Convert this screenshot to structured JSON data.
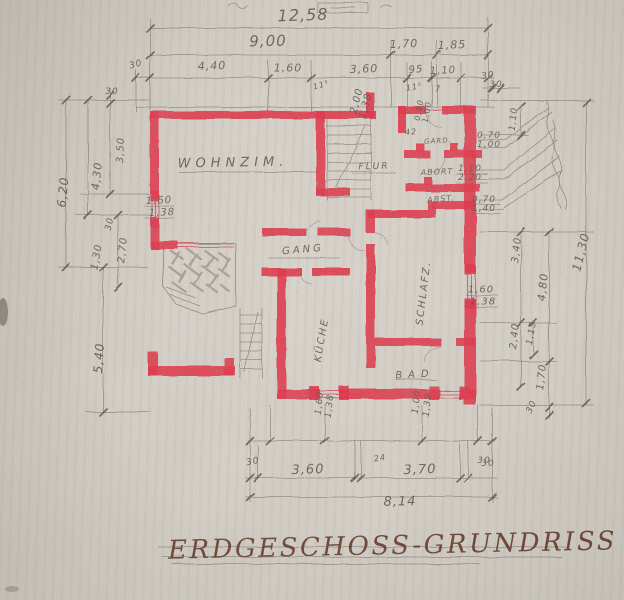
{
  "drawing": {
    "title": "ERDGESCHOSS-GRUNDRISS"
  },
  "colors": {
    "paper": "#d6d2ca",
    "wall_red": "#e23348",
    "pencil": "#6d665a",
    "title_ink": "#5a2c1b"
  },
  "room_labels": [
    {
      "name": "room-label-wohnzimmer",
      "text": "WOHNZIM.",
      "x": 233,
      "y": 163,
      "size": 13,
      "rot": -1,
      "ls": 5
    },
    {
      "name": "room-label-flur",
      "text": "FLUR",
      "x": 374,
      "y": 167,
      "size": 9,
      "rot": -2,
      "ls": 2
    },
    {
      "name": "room-label-gang",
      "text": "GANG",
      "x": 303,
      "y": 250,
      "size": 10,
      "rot": -5,
      "ls": 3
    },
    {
      "name": "room-label-schlafzimmer",
      "text": "SCHLAFZ.",
      "x": 424,
      "y": 293,
      "size": 10,
      "rot": -83,
      "ls": 2
    },
    {
      "name": "room-label-kueche",
      "text": "KÜCHE",
      "x": 322,
      "y": 340,
      "size": 10,
      "rot": -80,
      "ls": 2
    },
    {
      "name": "room-label-bad",
      "text": "BAD",
      "x": 415,
      "y": 375,
      "size": 10,
      "rot": -3,
      "ls": 6
    },
    {
      "name": "room-label-abort",
      "text": "ABORT",
      "x": 437,
      "y": 172,
      "size": 8,
      "rot": -2,
      "ls": 1
    },
    {
      "name": "room-label-abstellraum",
      "text": "ABST.",
      "x": 441,
      "y": 199,
      "size": 8,
      "rot": -5,
      "ls": 1
    },
    {
      "name": "room-label-garderobe",
      "text": "GARD.",
      "x": 438,
      "y": 141,
      "size": 7,
      "rot": -3,
      "ls": 1
    }
  ],
  "dimension_labels": [
    {
      "text": "12,58",
      "x": 303,
      "y": 15,
      "size": 16,
      "rot": -2
    },
    {
      "text": "9,00",
      "x": 268,
      "y": 41,
      "size": 15,
      "rot": -1
    },
    {
      "text": "1,70",
      "x": 404,
      "y": 44,
      "size": 11,
      "rot": -2
    },
    {
      "text": "1,85",
      "x": 452,
      "y": 45,
      "size": 11,
      "rot": -2
    },
    {
      "text": "30",
      "x": 136,
      "y": 65,
      "size": 9,
      "rot": -15
    },
    {
      "text": "4,40",
      "x": 212,
      "y": 66,
      "size": 11,
      "rot": -2
    },
    {
      "text": "1,60",
      "x": 288,
      "y": 68,
      "size": 11,
      "rot": 0
    },
    {
      "text": "3,60",
      "x": 364,
      "y": 69,
      "size": 11,
      "rot": -2
    },
    {
      "text": "95",
      "x": 416,
      "y": 70,
      "size": 10,
      "rot": -5
    },
    {
      "text": "1,10",
      "x": 443,
      "y": 71,
      "size": 10,
      "rot": -3
    },
    {
      "text": "11⁵",
      "x": 321,
      "y": 85,
      "size": 8,
      "rot": -15
    },
    {
      "text": "11⁵",
      "x": 414,
      "y": 87,
      "size": 8,
      "rot": -10
    },
    {
      "text": "7",
      "x": 438,
      "y": 89,
      "size": 8,
      "rot": 0
    },
    {
      "text": "30",
      "x": 488,
      "y": 76,
      "size": 9,
      "rot": -8
    },
    {
      "text": "30",
      "x": 112,
      "y": 92,
      "size": 9,
      "rot": 0
    },
    {
      "text": "3,50",
      "x": 121,
      "y": 150,
      "size": 10,
      "rot": -88
    },
    {
      "text": "4,30",
      "x": 97,
      "y": 176,
      "size": 11,
      "rot": -84
    },
    {
      "text": "6,20",
      "x": 63,
      "y": 192,
      "size": 12,
      "rot": -84
    },
    {
      "text": "30",
      "x": 110,
      "y": 224,
      "size": 9,
      "rot": -78
    },
    {
      "text": "2,70",
      "x": 123,
      "y": 250,
      "size": 10,
      "rot": -84
    },
    {
      "text": "1,30",
      "x": 97,
      "y": 257,
      "size": 10,
      "rot": -80
    },
    {
      "text": "1,60",
      "x": 159,
      "y": 201,
      "size": 10,
      "rot": -3
    },
    {
      "text": "1,38",
      "x": 162,
      "y": 213,
      "size": 10,
      "rot": -3
    },
    {
      "text": "5,40",
      "x": 99,
      "y": 358,
      "size": 12,
      "rot": -86
    },
    {
      "text": "11,30",
      "x": 581,
      "y": 252,
      "size": 12,
      "rot": -76
    },
    {
      "text": "4,80",
      "x": 543,
      "y": 287,
      "size": 11,
      "rot": -84
    },
    {
      "text": "3,40",
      "x": 517,
      "y": 250,
      "size": 10,
      "rot": -84
    },
    {
      "text": "1,10",
      "x": 514,
      "y": 119,
      "size": 9,
      "rot": -84
    },
    {
      "text": "30",
      "x": 496,
      "y": 85,
      "size": 9,
      "rot": 0
    },
    {
      "text": "2,40",
      "x": 515,
      "y": 336,
      "size": 10,
      "rot": -84
    },
    {
      "text": "1,15",
      "x": 532,
      "y": 333,
      "size": 9,
      "rot": -80
    },
    {
      "text": "1,70",
      "x": 542,
      "y": 377,
      "size": 10,
      "rot": -84
    },
    {
      "text": "30",
      "x": 532,
      "y": 407,
      "size": 9,
      "rot": -65
    },
    {
      "text": "30",
      "x": 488,
      "y": 464,
      "size": 9,
      "rot": 0
    },
    {
      "text": "1,60",
      "x": 481,
      "y": 290,
      "size": 10,
      "rot": 0
    },
    {
      "text": "1,38",
      "x": 483,
      "y": 302,
      "size": 10,
      "rot": 0
    },
    {
      "text": "0,70",
      "x": 489,
      "y": 136,
      "size": 9,
      "rot": 0
    },
    {
      "text": "1,00",
      "x": 489,
      "y": 145,
      "size": 9,
      "rot": 0
    },
    {
      "text": "1,10",
      "x": 470,
      "y": 169,
      "size": 9,
      "rot": 0
    },
    {
      "text": "2,20",
      "x": 470,
      "y": 178,
      "size": 9,
      "rot": 0
    },
    {
      "text": "0,70",
      "x": 484,
      "y": 200,
      "size": 9,
      "rot": 0
    },
    {
      "text": "1,40",
      "x": 484,
      "y": 209,
      "size": 9,
      "rot": 0
    },
    {
      "text": "2,00",
      "x": 357,
      "y": 101,
      "size": 10,
      "rot": -76
    },
    {
      "text": "1,38",
      "x": 366,
      "y": 106,
      "size": 10,
      "rot": -76
    },
    {
      "text": "0,80",
      "x": 419,
      "y": 110,
      "size": 8,
      "rot": -80
    },
    {
      "text": "1,00",
      "x": 427,
      "y": 112,
      "size": 8,
      "rot": -80
    },
    {
      "text": "42",
      "x": 411,
      "y": 132,
      "size": 8,
      "rot": -5
    },
    {
      "text": "1,60",
      "x": 320,
      "y": 403,
      "size": 9,
      "rot": -84
    },
    {
      "text": "1,38",
      "x": 330,
      "y": 406,
      "size": 9,
      "rot": -84
    },
    {
      "text": "1,00",
      "x": 417,
      "y": 402,
      "size": 9,
      "rot": -84
    },
    {
      "text": "1,39",
      "x": 428,
      "y": 405,
      "size": 9,
      "rot": -84
    },
    {
      "text": "30",
      "x": 253,
      "y": 462,
      "size": 9,
      "rot": -12
    },
    {
      "text": "3,60",
      "x": 308,
      "y": 470,
      "size": 13,
      "rot": -2
    },
    {
      "text": "24",
      "x": 380,
      "y": 458,
      "size": 8,
      "rot": -10
    },
    {
      "text": "3,70",
      "x": 420,
      "y": 470,
      "size": 13,
      "rot": -2
    },
    {
      "text": "30",
      "x": 484,
      "y": 461,
      "size": 9,
      "rot": 0
    },
    {
      "text": "8,14",
      "x": 400,
      "y": 502,
      "size": 13,
      "rot": -1
    }
  ]
}
